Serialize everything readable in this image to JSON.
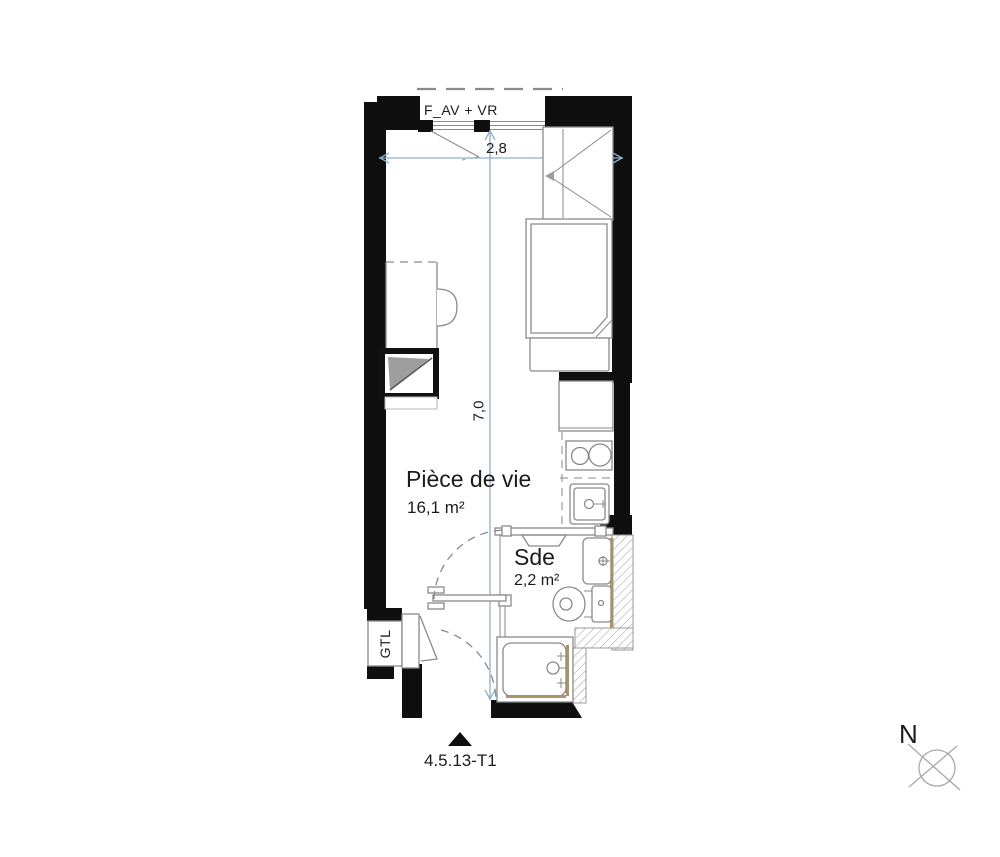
{
  "floor_plan": {
    "window_label": "F_AV + VR",
    "dimensions": {
      "width_m": "2,8",
      "depth_m": "7,0"
    },
    "rooms": [
      {
        "name": "Pièce de vie",
        "area": "16,1 m²"
      },
      {
        "name": "Sde",
        "area": "2,2 m²"
      }
    ],
    "gtl_label": "GTL",
    "unit_ref": "4.5.13-T1",
    "north_label": "N"
  },
  "colors": {
    "wall": "#0f0f0f",
    "dimension_line": "#8fafc9",
    "furniture_line": "#8a8a8a",
    "hatch_line": "#a8a8a8",
    "wood_trim": "#ab9566",
    "gray_fill": "#9e9e9e",
    "label_text": "#1c1c1c"
  }
}
